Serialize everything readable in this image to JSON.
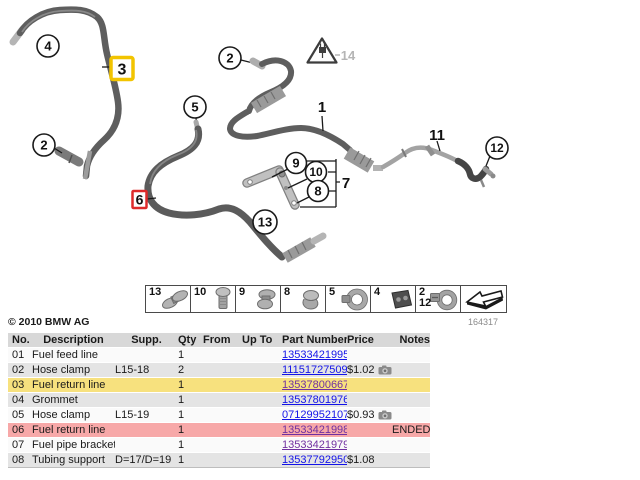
{
  "copyright": "© 2010 BMW AG",
  "diagram_number": "164317",
  "colors": {
    "highlight_yellow": "#F7E17E",
    "highlight_red": "#F7A8A8",
    "header_gray": "#D8D8D8",
    "row_gray": "#E4E4E4",
    "link_blue": "#1414E8",
    "link_visited": "#7030A0",
    "box_yellow": "#F2C400",
    "box_red": "#DE2B2B"
  },
  "diagram": {
    "callouts": {
      "c1": "1",
      "c2_left": "2",
      "c2_top": "2",
      "c3": "3",
      "c4": "4",
      "c5": "5",
      "c6": "6",
      "c7": "7",
      "c8": "8",
      "c9": "9",
      "c10": "10",
      "c11": "11",
      "c12": "12",
      "c13": "13",
      "c14": "14"
    },
    "thumbnails": [
      {
        "labels": [
          "13"
        ],
        "icon": "clip-double"
      },
      {
        "labels": [
          "10"
        ],
        "icon": "bolt"
      },
      {
        "labels": [
          "9"
        ],
        "icon": "clip"
      },
      {
        "labels": [
          "8"
        ],
        "icon": "clamp-half"
      },
      {
        "labels": [
          "5"
        ],
        "icon": "hose-clamp"
      },
      {
        "labels": [
          "4"
        ],
        "icon": "grommet-block"
      },
      {
        "labels": [
          "2",
          "12"
        ],
        "icon": "hose-clamp-screw"
      },
      {
        "labels": [],
        "icon": "direction-arrow"
      }
    ]
  },
  "table": {
    "headers": {
      "no": "No.",
      "description": "Description",
      "supp": "Supp.",
      "qty": "Qty",
      "from": "From",
      "up_to": "Up To",
      "part_number": "Part Number",
      "price": "Price",
      "notes": "Notes"
    },
    "rows": [
      {
        "no": "01",
        "description": "Fuel feed line",
        "supp": "",
        "qty": "1",
        "from": "",
        "up_to": "",
        "part_number": "13533421995",
        "price": "",
        "notes": "",
        "bg": "white",
        "visited": false,
        "has_photo": false
      },
      {
        "no": "02",
        "description": "Hose clamp",
        "supp": "L15-18",
        "qty": "2",
        "from": "",
        "up_to": "",
        "part_number": "11151727509",
        "price": "$1.02",
        "notes": "",
        "bg": "gray",
        "visited": false,
        "has_photo": true
      },
      {
        "no": "03",
        "description": "Fuel return line",
        "supp": "",
        "qty": "1",
        "from": "",
        "up_to": "",
        "part_number": "13537800667",
        "price": "",
        "notes": "",
        "bg": "yellow",
        "visited": true,
        "has_photo": false
      },
      {
        "no": "04",
        "description": "Grommet",
        "supp": "",
        "qty": "1",
        "from": "",
        "up_to": "",
        "part_number": "13537801976",
        "price": "",
        "notes": "",
        "bg": "gray",
        "visited": false,
        "has_photo": false
      },
      {
        "no": "05",
        "description": "Hose clamp",
        "supp": "L15-19",
        "qty": "1",
        "from": "",
        "up_to": "",
        "part_number": "07129952107",
        "price": "$0.93",
        "notes": "",
        "bg": "white",
        "visited": false,
        "has_photo": true
      },
      {
        "no": "06",
        "description": "Fuel return line",
        "supp": "",
        "qty": "1",
        "from": "",
        "up_to": "",
        "part_number": "13533421998",
        "price": "",
        "notes": "ENDED",
        "bg": "red",
        "visited": true,
        "has_photo": false
      },
      {
        "no": "07",
        "description": "Fuel pipe bracket",
        "supp": "",
        "qty": "1",
        "from": "",
        "up_to": "",
        "part_number": "13533421979",
        "price": "",
        "notes": "",
        "bg": "white",
        "visited": true,
        "has_photo": false
      },
      {
        "no": "08",
        "description": "Tubing support",
        "supp": "D=17/D=19",
        "qty": "1",
        "from": "",
        "up_to": "",
        "part_number": "13537792950",
        "price": "$1.08",
        "notes": "",
        "bg": "gray",
        "visited": false,
        "has_photo": false
      }
    ]
  }
}
